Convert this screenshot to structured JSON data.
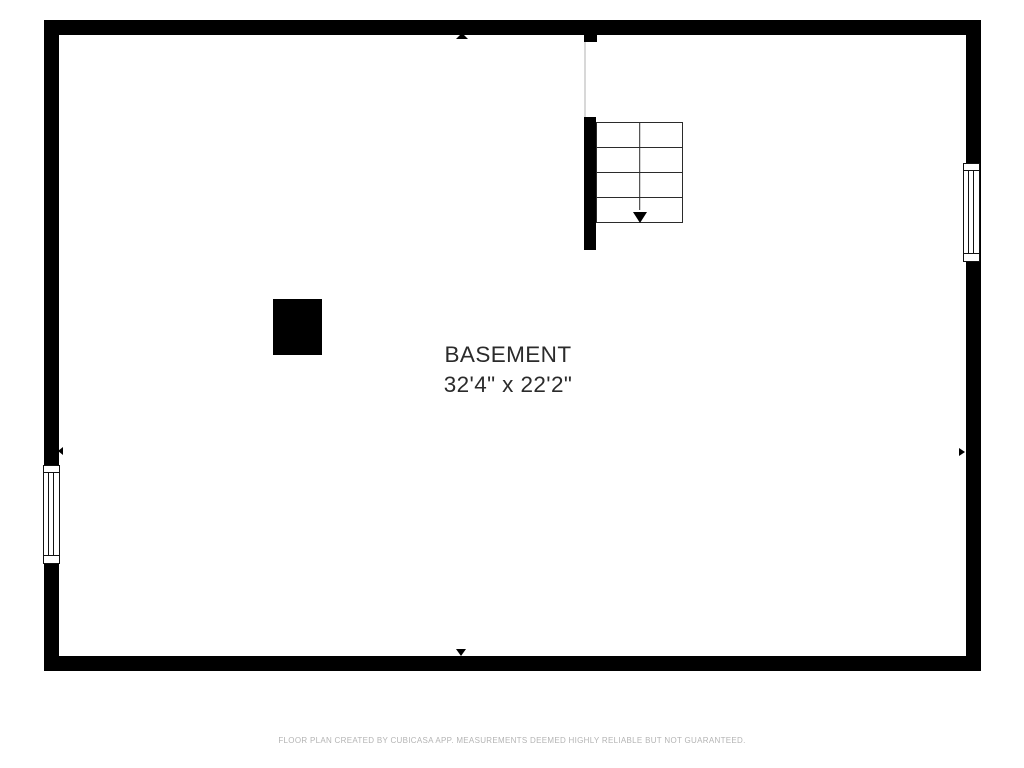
{
  "floor_plan": {
    "room": {
      "name": "BASEMENT",
      "dimensions": "32'4\" x 22'2\""
    },
    "stairs": {
      "steps": 4,
      "direction": "down"
    },
    "footer": {
      "disclaimer": "FLOOR PLAN CREATED BY CUBICASA APP. MEASUREMENTS DEEMED HIGHLY RELIABLE BUT NOT GUARANTEED."
    },
    "colors": {
      "background": "#ffffff",
      "wall": "#000000",
      "stair_lines": "#2b2b2b",
      "opening_line": "#d8d8d8",
      "label_text": "#2b2b2b",
      "footer_text": "#b4b4b4"
    }
  }
}
